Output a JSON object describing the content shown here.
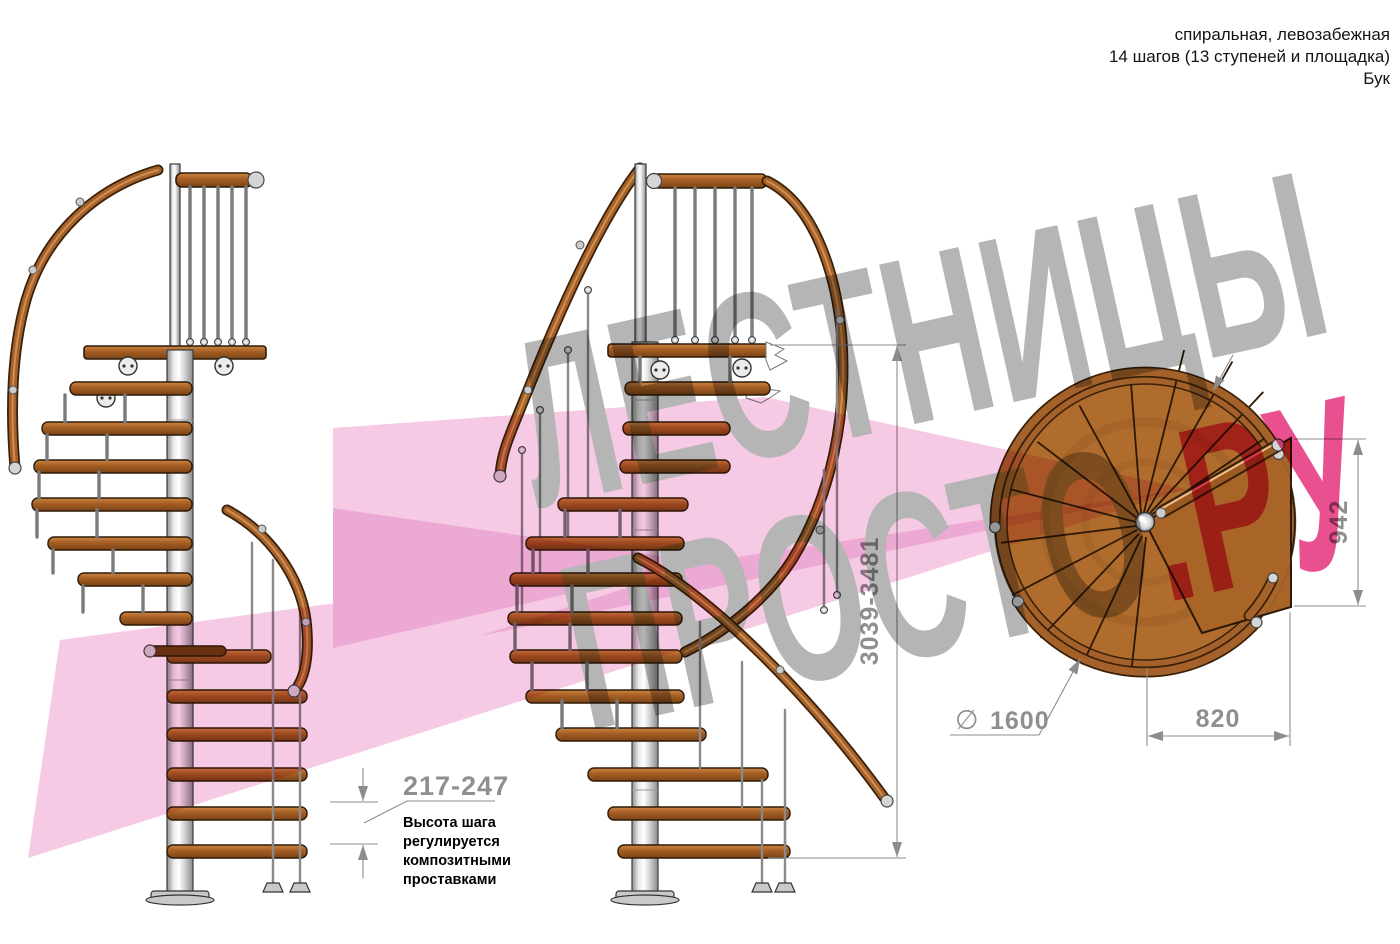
{
  "title_block": {
    "line1": "спиральная, левозабежная",
    "line2": "14 шагов (13 ступеней и площадка)",
    "line3": "Бук"
  },
  "watermark": {
    "word1": "ЛЕСТНИЦЫ",
    "word2": "ПРОСТО",
    "word2_suffix": ".РУ"
  },
  "elevation_dimensions": {
    "total_height_range": "3039-3481",
    "step_height_range": "217-247",
    "note_lines": [
      "Высота шага",
      "регулируется",
      "композитными",
      "проставками"
    ]
  },
  "plan_dimensions": {
    "landing_width": "942",
    "landing_depth": "820",
    "diameter_symbol": "∅",
    "diameter_value": "1600"
  },
  "colors": {
    "wood": "#a86026",
    "wood_dark": "#3a2008",
    "metal": "#d9d9d9",
    "dimension_gray": "#8f8f8f",
    "watermark_gray": "#b5b5b5",
    "watermark_pink": "#e9508f",
    "ribbon_pink": "#f6c9e4",
    "text_black": "#141414"
  }
}
